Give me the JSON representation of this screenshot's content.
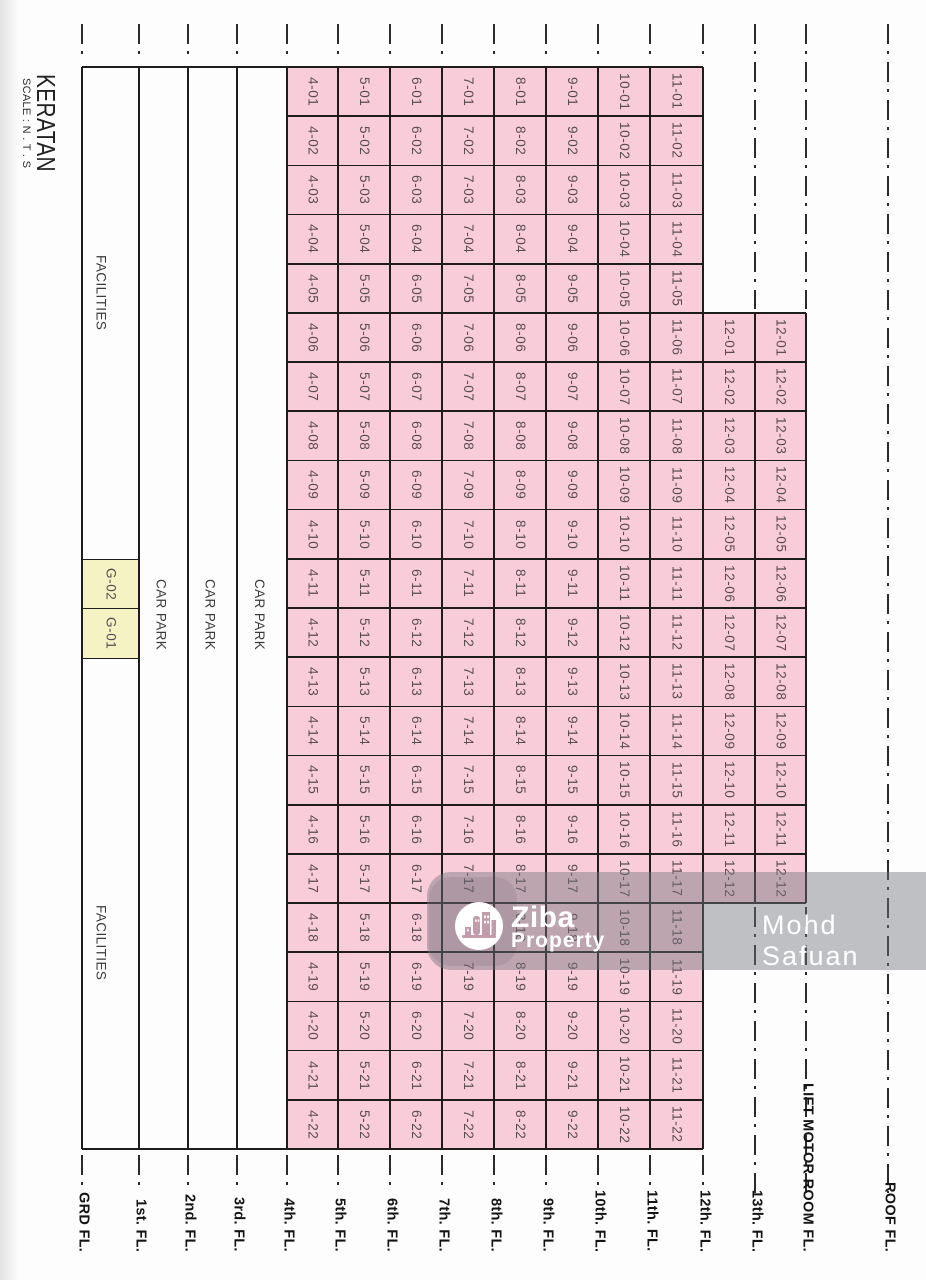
{
  "title": "KERATAN",
  "scale_note": "SCALE : N . T . S",
  "watermark": {
    "brand_top": "Ziba",
    "brand_bottom": "Property",
    "author": "Mohd Safuan",
    "logo_icon": "city-buildings-icon"
  },
  "colors": {
    "unit_fill": "#f9ccda",
    "ground_unit_fill": "#f5f3c3",
    "line": "#1d1d1d",
    "unit_text": "#5a4c53",
    "drawing_text": "#3a3a3a",
    "floor_label_text": "#141414",
    "watermark_band": "rgba(116,118,124,0.45)",
    "watermark_text": "#ffffff",
    "logo_icon_color": "#c39cab"
  },
  "layout": {
    "width": 926,
    "height": 1280,
    "grid_top": 67,
    "grid_bottom": 1149,
    "row_count": 22,
    "floor_lines": [
      82,
      139,
      188,
      237,
      287,
      338,
      390,
      442,
      494,
      546,
      598,
      650,
      703,
      755,
      806,
      888
    ],
    "offset_block_start_row": 5,
    "offset_block_rows": 12,
    "stub_top_y": 24,
    "stub_len": 38,
    "stub_bottom_y": 1155,
    "label_bottom_offset": 28,
    "facility_text_centers_y": [
      293,
      943
    ],
    "carpark_text_center_y": 615,
    "ground_units_start_row": 10
  },
  "floors": [
    {
      "label": "GRD FL.",
      "kind": "facilities",
      "facility_labels": [
        "FACILITIES",
        "FACILITIES"
      ],
      "ground_units": [
        "G-02",
        "G-01"
      ]
    },
    {
      "label": "1st. FL.",
      "kind": "carpark",
      "text": "CAR PARK"
    },
    {
      "label": "2nd. FL.",
      "kind": "carpark",
      "text": "CAR PARK"
    },
    {
      "label": "3rd. FL.",
      "kind": "carpark",
      "text": "CAR PARK"
    },
    {
      "label": "4th. FL.",
      "kind": "units",
      "units": [
        "4-01",
        "4-02",
        "4-03",
        "4-04",
        "4-05",
        "4-06",
        "4-07",
        "4-08",
        "4-09",
        "4-10",
        "4-11",
        "4-12",
        "4-13",
        "4-14",
        "4-15",
        "4-16",
        "4-17",
        "4-18",
        "4-19",
        "4-20",
        "4-21",
        "4-22"
      ]
    },
    {
      "label": "5th. FL.",
      "kind": "units",
      "units": [
        "5-01",
        "5-02",
        "5-03",
        "5-04",
        "5-05",
        "5-06",
        "5-07",
        "5-08",
        "5-09",
        "5-10",
        "5-11",
        "5-12",
        "5-13",
        "5-14",
        "5-15",
        "5-16",
        "5-17",
        "5-18",
        "5-19",
        "5-20",
        "5-21",
        "5-22"
      ]
    },
    {
      "label": "6th. FL.",
      "kind": "units",
      "units": [
        "6-01",
        "6-02",
        "6-03",
        "6-04",
        "6-05",
        "6-06",
        "6-07",
        "6-08",
        "6-09",
        "6-10",
        "6-11",
        "6-12",
        "6-13",
        "6-14",
        "6-15",
        "6-16",
        "6-17",
        "6-18",
        "6-19",
        "6-20",
        "6-21",
        "6-22"
      ]
    },
    {
      "label": "7th. FL.",
      "kind": "units",
      "units": [
        "7-01",
        "7-02",
        "7-03",
        "7-04",
        "7-05",
        "7-06",
        "7-07",
        "7-08",
        "7-09",
        "7-10",
        "7-11",
        "7-12",
        "7-13",
        "7-14",
        "7-15",
        "7-16",
        "7-17",
        "7-18",
        "7-19",
        "7-20",
        "7-21",
        "7-22"
      ]
    },
    {
      "label": "8th. FL.",
      "kind": "units",
      "units": [
        "8-01",
        "8-02",
        "8-03",
        "8-04",
        "8-05",
        "8-06",
        "8-07",
        "8-08",
        "8-09",
        "8-10",
        "8-11",
        "8-12",
        "8-13",
        "8-14",
        "8-15",
        "8-16",
        "8-17",
        "8-18",
        "8-19",
        "8-20",
        "8-21",
        "8-22"
      ]
    },
    {
      "label": "9th. FL.",
      "kind": "units",
      "units": [
        "9-01",
        "9-02",
        "9-03",
        "9-04",
        "9-05",
        "9-06",
        "9-07",
        "9-08",
        "9-09",
        "9-10",
        "9-11",
        "9-12",
        "9-13",
        "9-14",
        "9-15",
        "9-16",
        "9-17",
        "9-18",
        "9-19",
        "9-20",
        "9-21",
        "9-22"
      ]
    },
    {
      "label": "10th. FL.",
      "kind": "units",
      "units": [
        "10-01",
        "10-02",
        "10-03",
        "10-04",
        "10-05",
        "10-06",
        "10-07",
        "10-08",
        "10-09",
        "10-10",
        "10-11",
        "10-12",
        "10-13",
        "10-14",
        "10-15",
        "10-16",
        "10-17",
        "10-18",
        "10-19",
        "10-20",
        "10-21",
        "10-22"
      ]
    },
    {
      "label": "11th. FL.",
      "kind": "units",
      "units": [
        "11-01",
        "11-02",
        "11-03",
        "11-04",
        "11-05",
        "11-06",
        "11-07",
        "11-08",
        "11-09",
        "11-10",
        "11-11",
        "11-12",
        "11-13",
        "11-14",
        "11-15",
        "11-16",
        "11-17",
        "11-18",
        "11-19",
        "11-20",
        "11-21",
        "11-22"
      ]
    },
    {
      "label": "12th. FL.",
      "kind": "units_offset",
      "units": [
        "12-01",
        "12-02",
        "12-03",
        "12-04",
        "12-05",
        "12-06",
        "12-07",
        "12-08",
        "12-09",
        "12-10",
        "12-11",
        "12-12"
      ]
    },
    {
      "label": "13th. FL.",
      "kind": "units_offset",
      "units": [
        "12-01",
        "12-02",
        "12-03",
        "12-04",
        "12-05",
        "12-06",
        "12-07",
        "12-08",
        "12-09",
        "12-10",
        "12-11",
        "12-12"
      ]
    },
    {
      "label": "LIFT MOTOR ROOM FL.",
      "kind": "empty"
    },
    {
      "label": "ROOF FL.",
      "kind": "empty"
    }
  ]
}
